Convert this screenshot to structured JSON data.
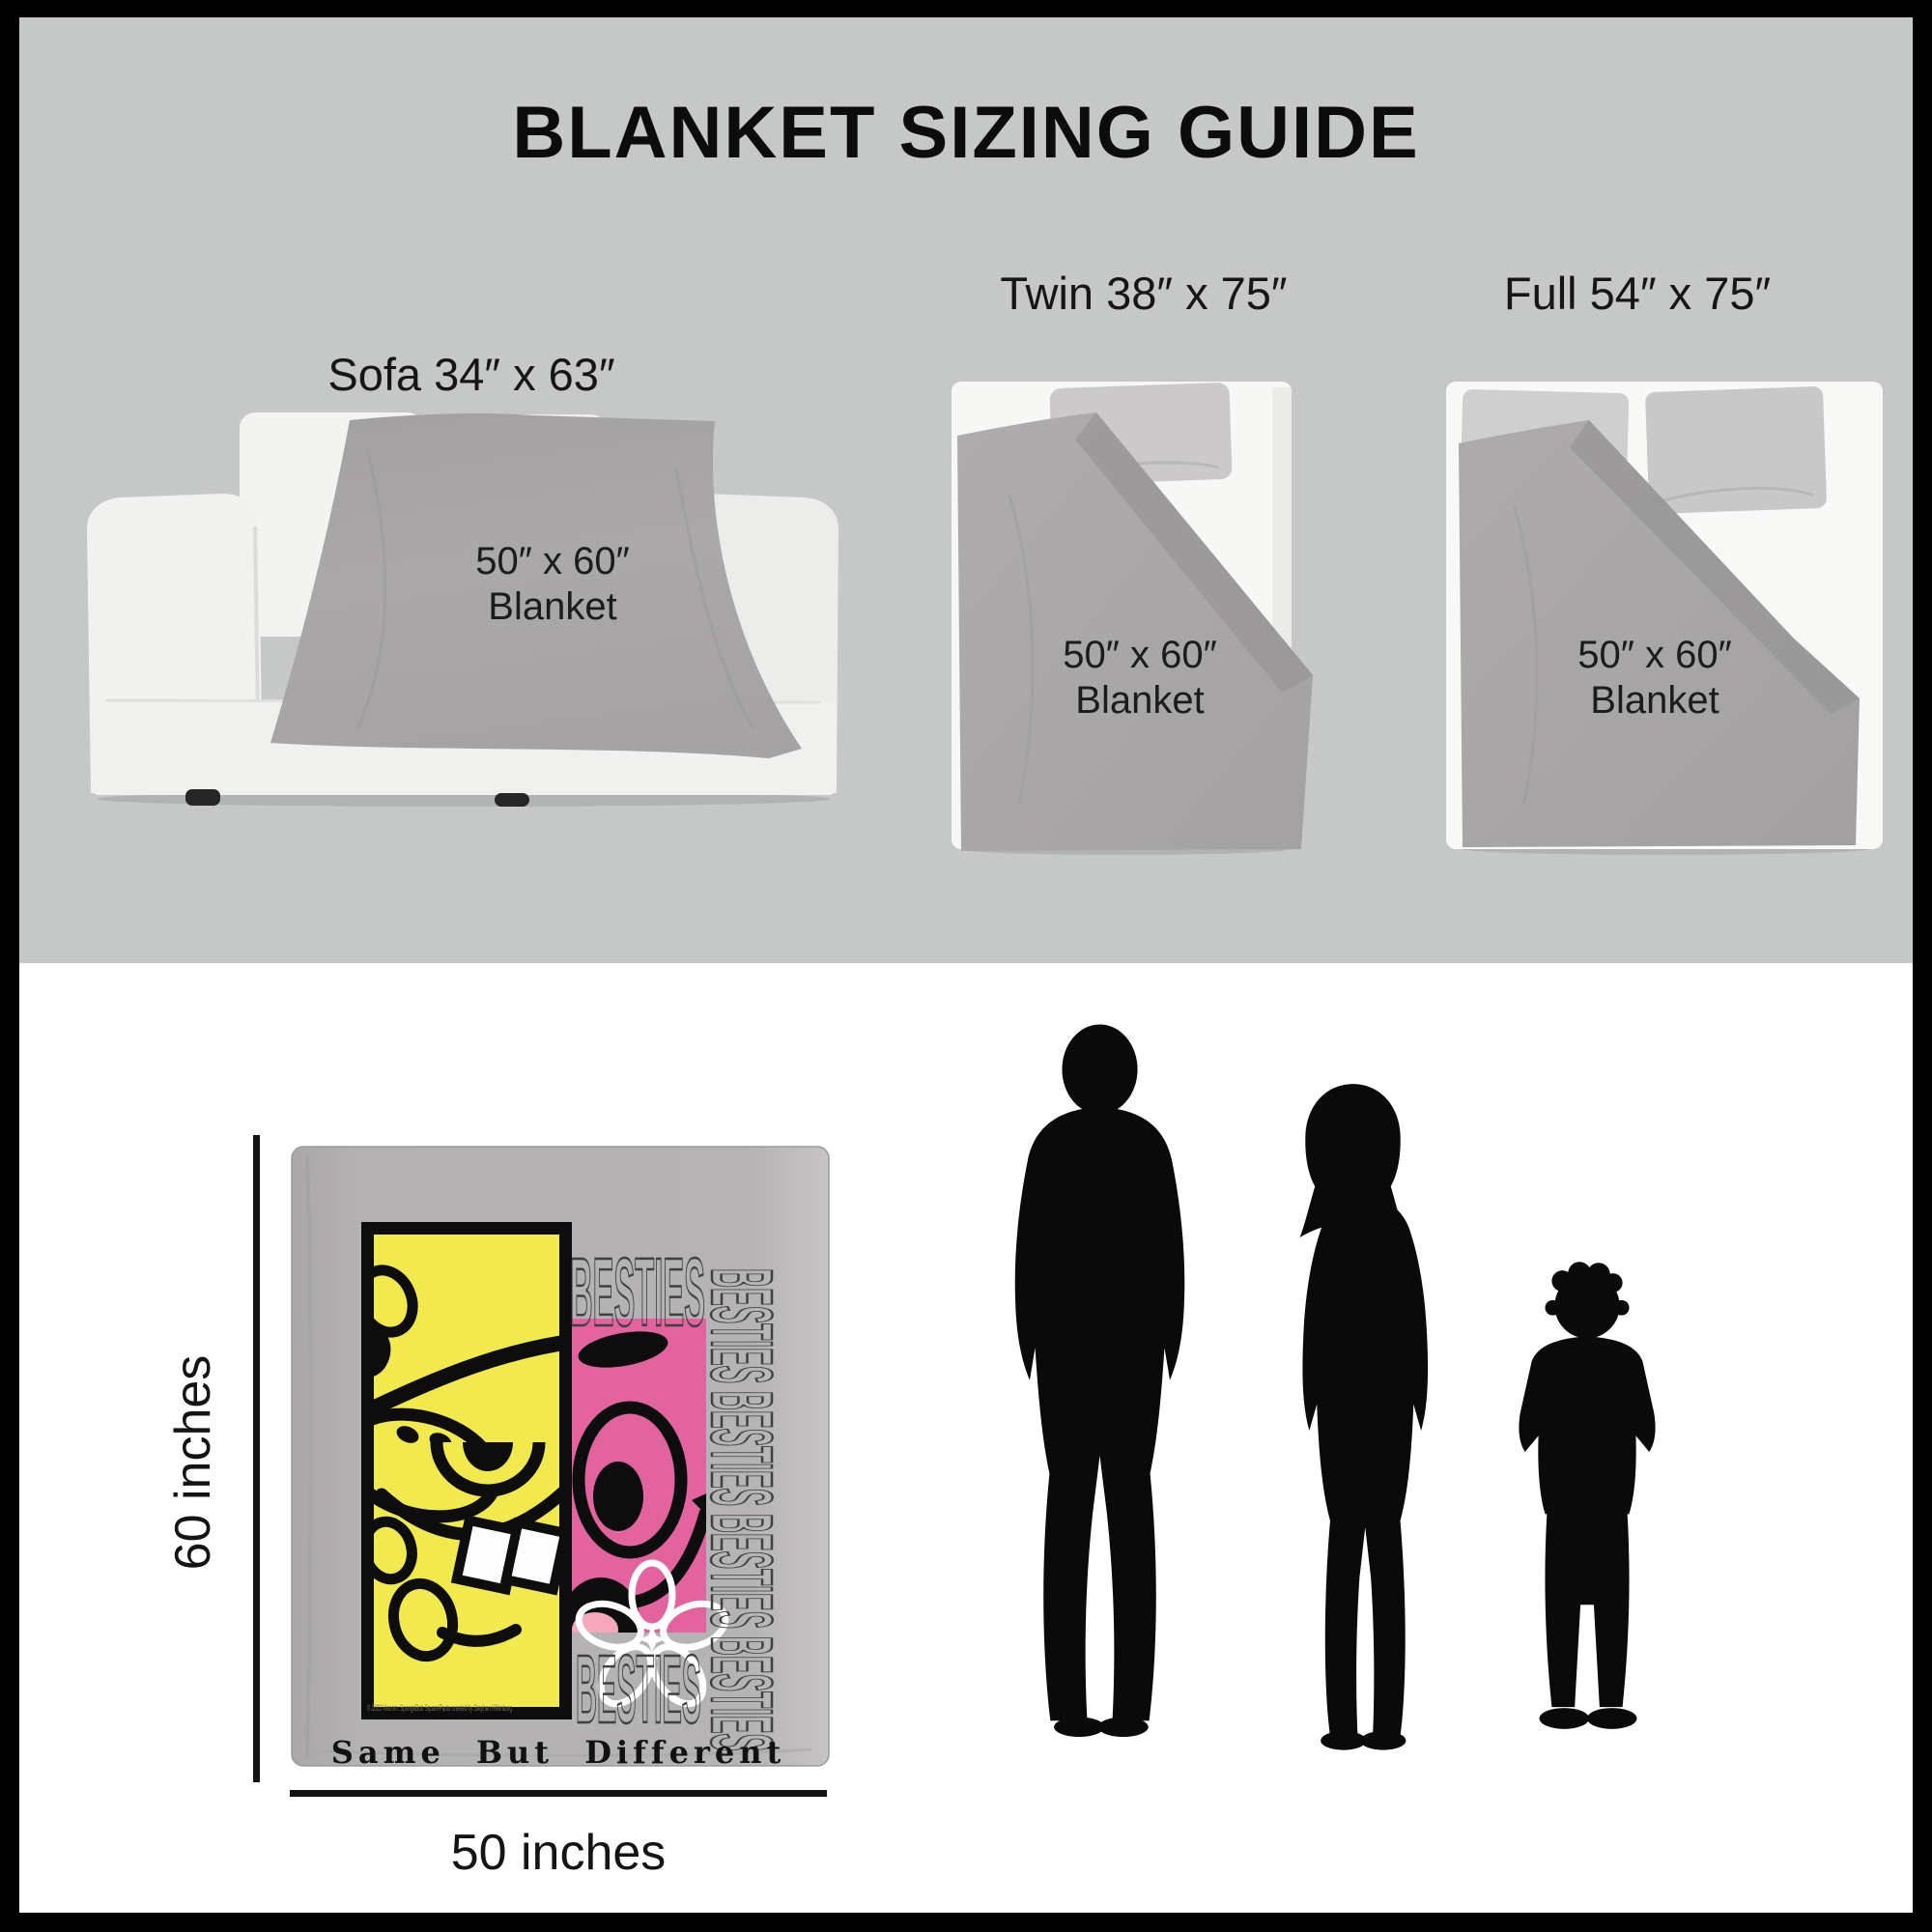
{
  "title": "BLANKET SIZING GUIDE",
  "sofa": {
    "label": "Sofa 34″ x 63″",
    "blanket_size": "50″ x 60″",
    "blanket_word": "Blanket"
  },
  "twin": {
    "label": "Twin 38″ x 75″",
    "blanket_size": "50″ x 60″",
    "blanket_word": "Blanket"
  },
  "full": {
    "label": "Full 54″ x 75″",
    "blanket_size": "50″ x 60″",
    "blanket_word": "Blanket"
  },
  "dimensions": {
    "height_label": "60 inches",
    "width_label": "50 inches"
  },
  "blanket_art": {
    "besties_top": "BESTIES",
    "besties_bottom": "BESTIES",
    "besties_vertical": "BESTIES BESTIES BESTIES BESTIES",
    "tagline": "Same But Different",
    "copyright": "© 2023 Viacom. SpongeBob SquarePants created by Stephen Hillenburg",
    "colors": {
      "yellow": "#f2e94e",
      "pink": "#e2639d",
      "tongue_pink": "#f4a8ba",
      "blanket_gray": "#b1afb0",
      "outline_gray": "#404040"
    }
  },
  "scene": {
    "background_top": "#c5c8c7",
    "background_bottom": "#ffffff",
    "frame_color": "#000000",
    "bed_blanket_gray": "#a8a6a7",
    "silhouette_color": "#0a0a0a"
  }
}
